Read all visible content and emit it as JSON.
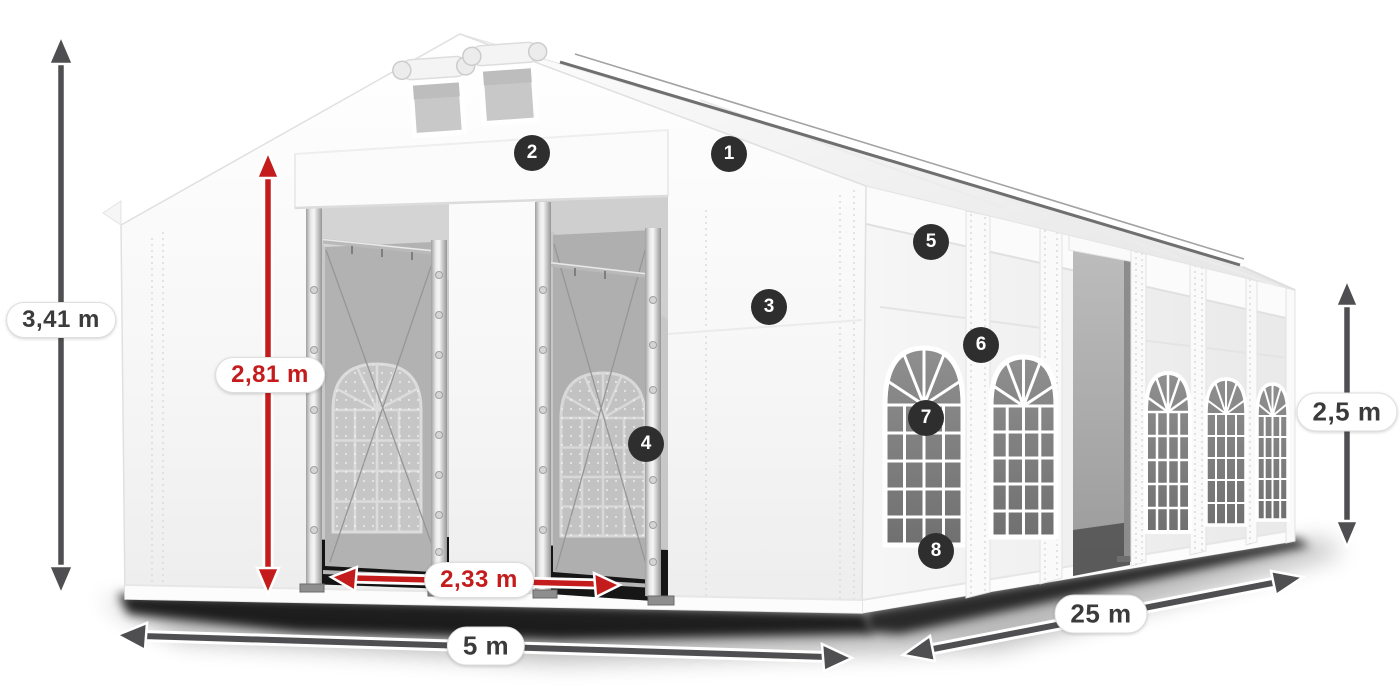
{
  "diagram": {
    "subject": "White party marquee tent with dimension callouts",
    "background": "#ffffff"
  },
  "colors": {
    "dimension_red": "#c41c1c",
    "dimension_gray": "#4f4f51",
    "marker_bg": "#2e2e2e",
    "marker_text": "#ffffff",
    "label_bg": "#ffffff",
    "label_text": "#3b3b3b",
    "tent_white": "#f5f5f5"
  },
  "dims": {
    "total_height": "3,41 m",
    "door_height": "2,81 m",
    "door_width": "2,33 m",
    "front_width": "5 m",
    "side_length": "25 m",
    "side_height": "2,5 m"
  },
  "markers": [
    {
      "number": "1"
    },
    {
      "number": "2"
    },
    {
      "number": "3"
    },
    {
      "number": "4"
    },
    {
      "number": "5"
    },
    {
      "number": "6"
    },
    {
      "number": "7"
    },
    {
      "number": "8"
    }
  ]
}
